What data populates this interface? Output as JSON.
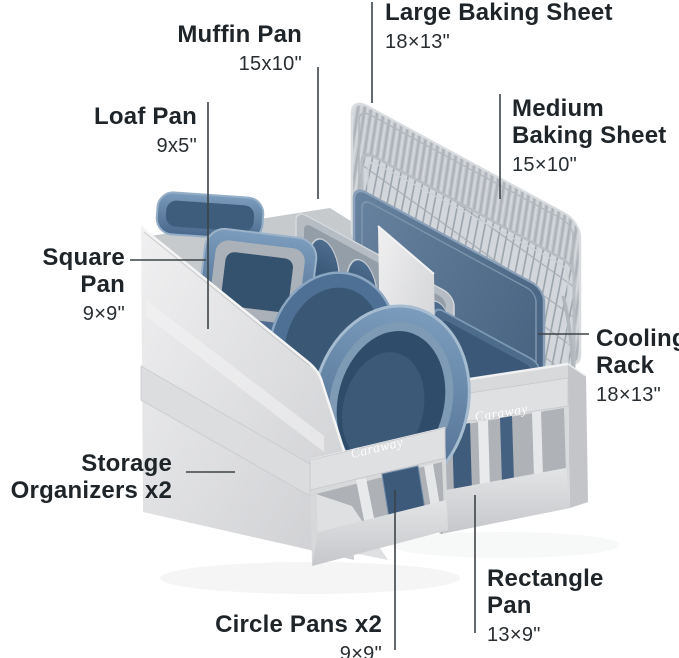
{
  "brand": "Caraway",
  "labels": {
    "muffin_pan": {
      "name": "Muffin Pan",
      "dim": "15x10\""
    },
    "large_baking_sheet": {
      "name": "Large Baking Sheet",
      "dim": "18×13\""
    },
    "loaf_pan": {
      "name": "Loaf Pan",
      "dim": "9x5\""
    },
    "medium_baking_sheet": {
      "name": "Medium\nBaking Sheet",
      "dim": "15×10\""
    },
    "square_pan": {
      "name": "Square Pan",
      "dim": "9×9\""
    },
    "cooling_rack": {
      "name": "Cooling\nRack",
      "dim": "18×13\""
    },
    "storage_organizers": {
      "name": "Storage\nOrganizers x2",
      "dim": ""
    },
    "circle_pans": {
      "name": "Circle Pans x2",
      "dim": "9×9\""
    },
    "rectangle_pan": {
      "name": "Rectangle\nPan",
      "dim": "13×9\""
    }
  },
  "colors": {
    "pan_blue": "#56789b",
    "pan_blue_dark": "#2f4d6b",
    "fabric_gray": "#d8d9db",
    "metal_silver": "#c6cacf",
    "text": "#1f2428",
    "leader_line": "#3c4347"
  }
}
